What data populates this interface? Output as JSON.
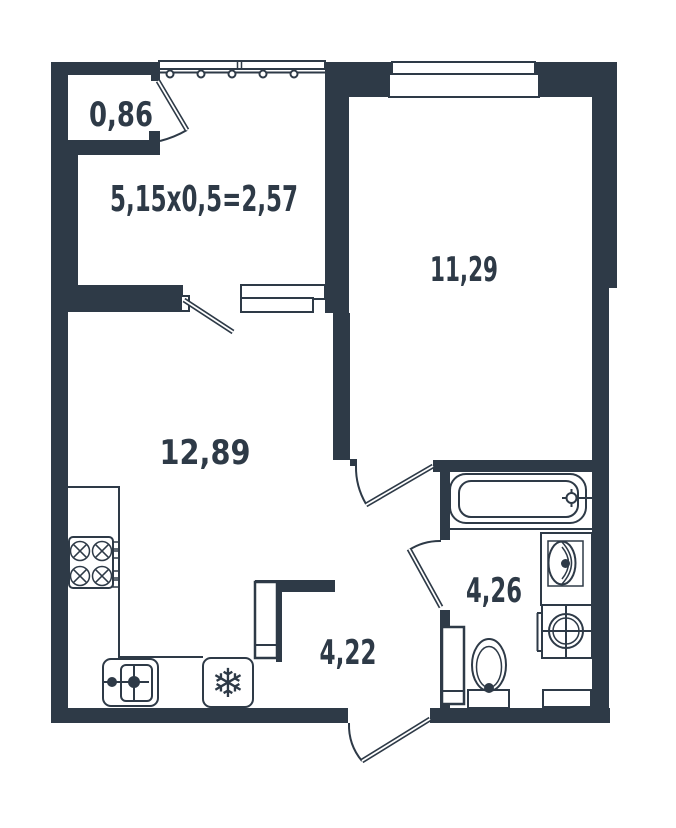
{
  "plan": {
    "colors": {
      "ink": "#2e3a47",
      "background": "#ffffff"
    },
    "labels": {
      "balcony_closet": "0,86",
      "balcony_calc": "5,15x0,5=2,57",
      "bedroom": "11,29",
      "living_kitchen": "12,89",
      "bathroom": "4,26",
      "hallway": "4,22"
    },
    "icons": {
      "fridge_snowflake": "❄"
    }
  }
}
